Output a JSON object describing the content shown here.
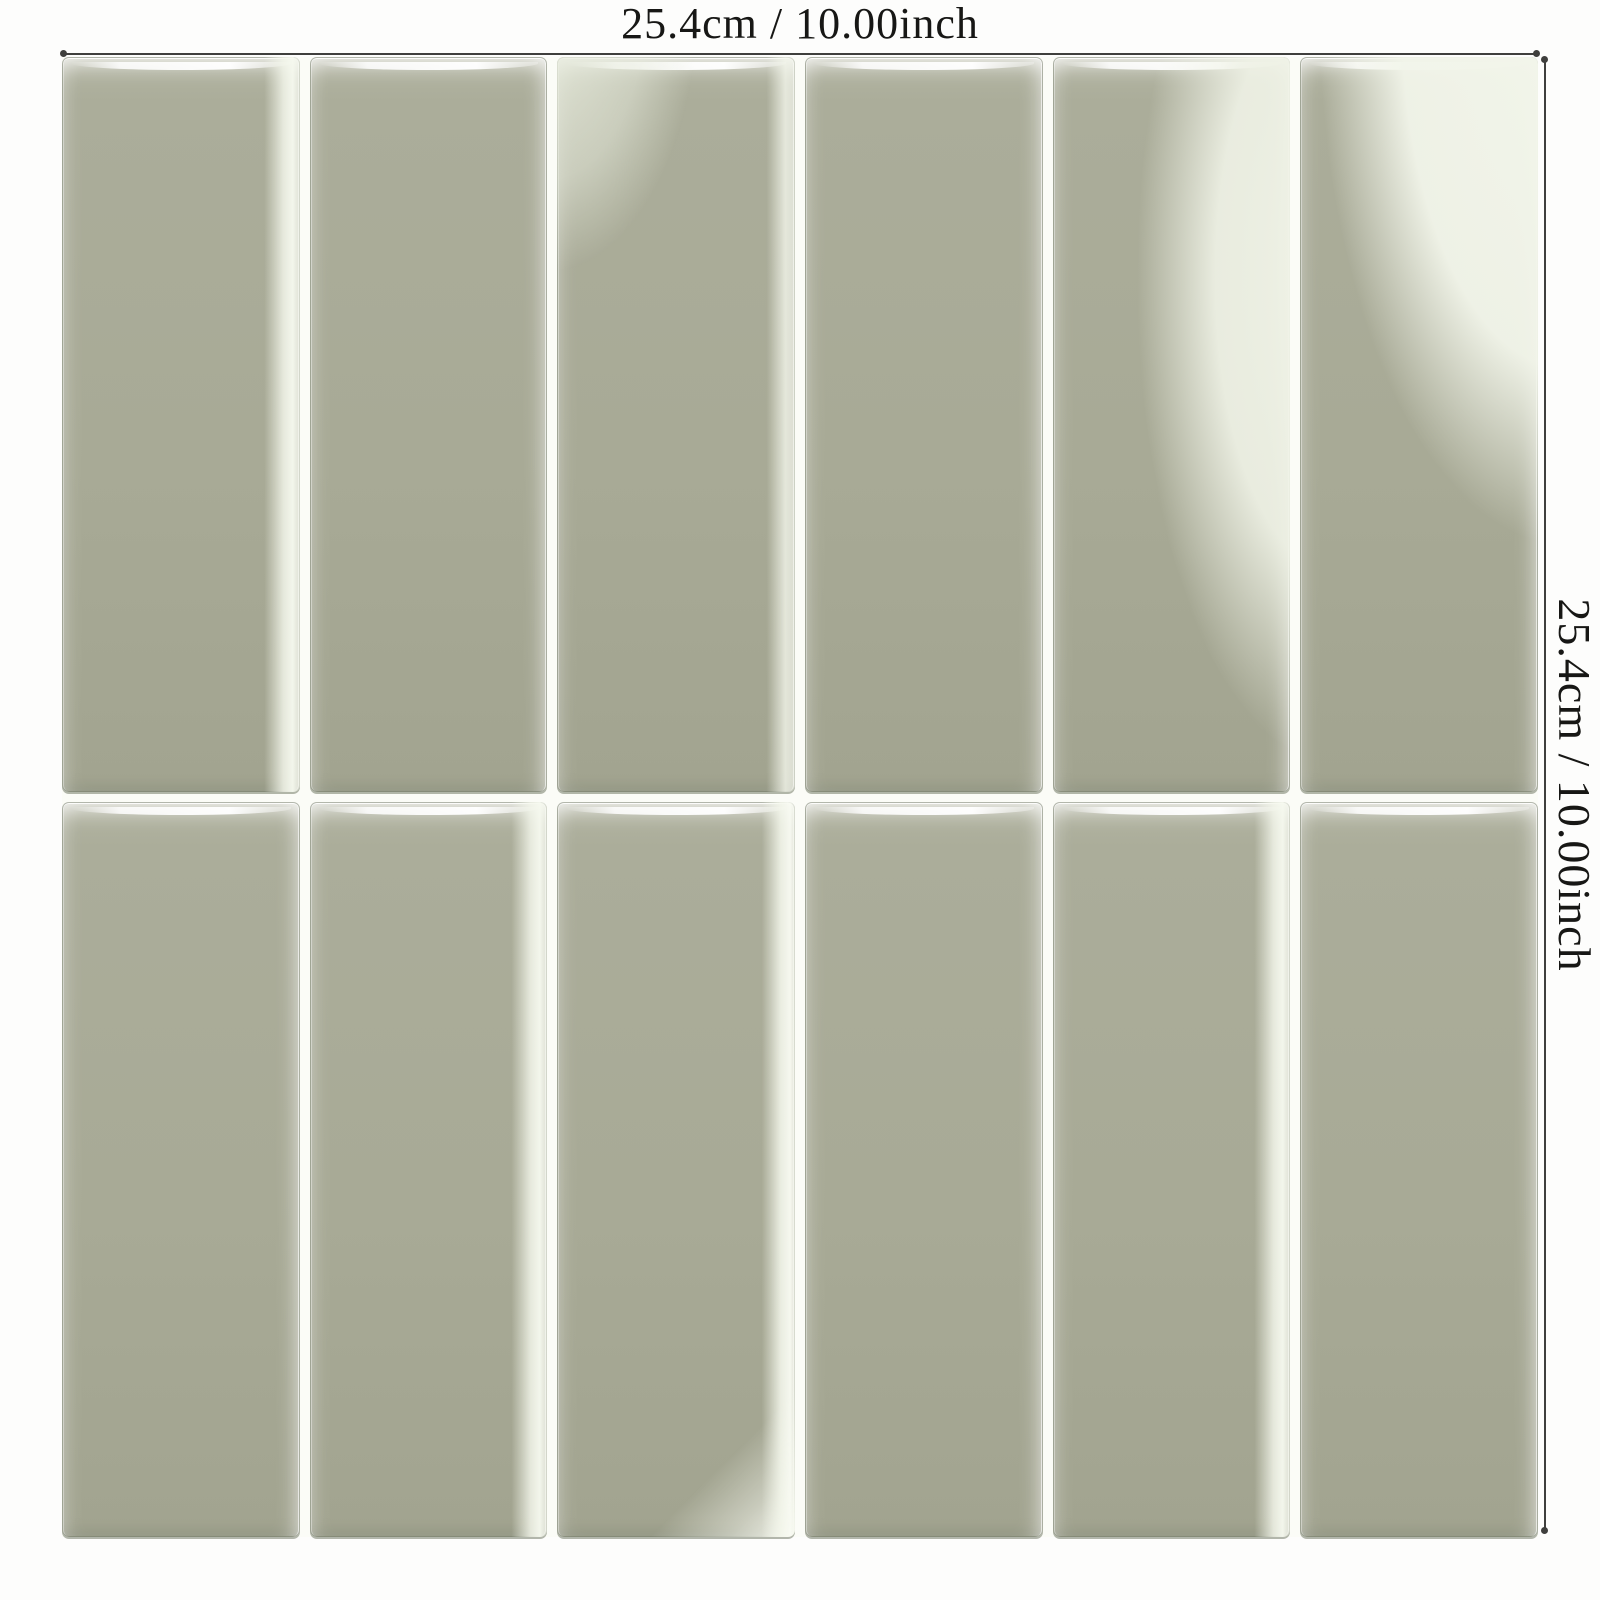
{
  "image_type": "product-dimension-diagram",
  "dimensions": {
    "top_label": "25.4cm / 10.00inch",
    "right_label": "25.4cm / 10.00inch"
  },
  "colors": {
    "background": "#fdfdfc",
    "tile_base": "#a8aa96",
    "tile_sheen": "#eef0e4",
    "grout": "#fbfcf7",
    "dimension_line": "#3f3f3d"
  },
  "tile_sheet": {
    "columns": 6,
    "rows": 2,
    "tiles": [
      {
        "row": 1,
        "col": 1,
        "variant": "right-band"
      },
      {
        "row": 1,
        "col": 2,
        "variant": "std"
      },
      {
        "row": 1,
        "col": 3,
        "variant": "sheen-topleft"
      },
      {
        "row": 1,
        "col": 4,
        "variant": "std"
      },
      {
        "row": 1,
        "col": 5,
        "variant": "sheen-right"
      },
      {
        "row": 1,
        "col": 6,
        "variant": "sheen-large"
      },
      {
        "row": 2,
        "col": 1,
        "variant": "std"
      },
      {
        "row": 2,
        "col": 2,
        "variant": "right-band"
      },
      {
        "row": 2,
        "col": 3,
        "variant": "corner-br"
      },
      {
        "row": 2,
        "col": 4,
        "variant": "std"
      },
      {
        "row": 2,
        "col": 5,
        "variant": "right-band"
      },
      {
        "row": 2,
        "col": 6,
        "variant": "std"
      }
    ]
  }
}
